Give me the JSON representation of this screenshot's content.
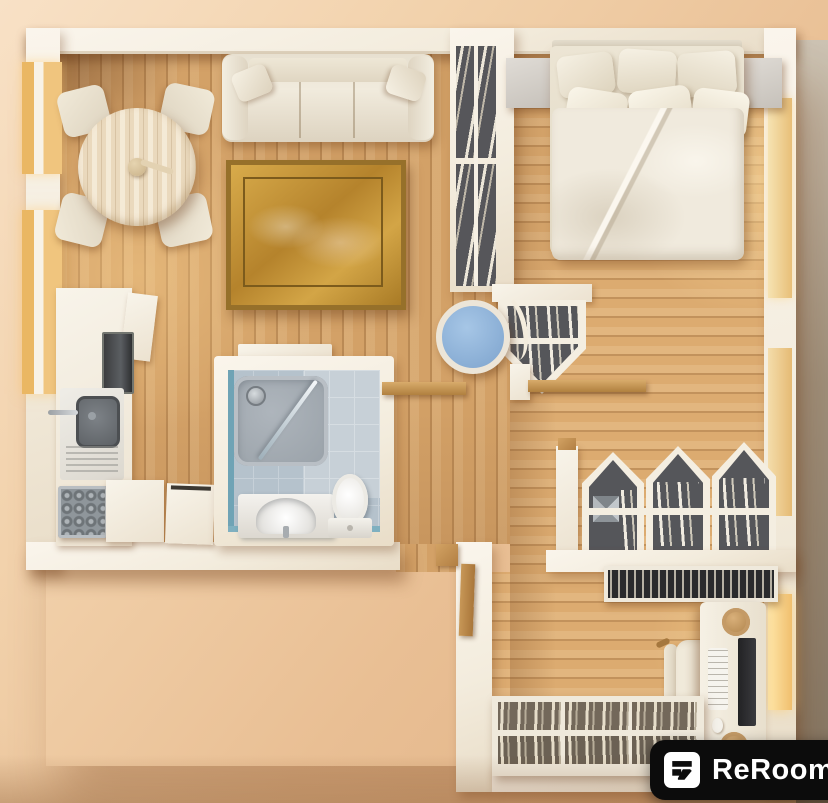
{
  "watermark": {
    "text": "ReRoom",
    "icon": "reroom-logo-icon",
    "bg": "#0c0c0c",
    "fg": "#ffffff"
  },
  "scene": {
    "type": "top-down 3D floor plan render",
    "rooms": [
      {
        "name": "living-dining-room",
        "items": [
          "cream sofa with throw pillows",
          "round birch dining table",
          "4 dining chairs",
          "gilded picture frame with sky canvas",
          "wall console shelf"
        ]
      },
      {
        "name": "kitchen",
        "items": [
          "counter run",
          "built-in oven",
          "sink with faucet",
          "drainboard",
          "cooktop hob",
          "dishwasher",
          "washing machine"
        ]
      },
      {
        "name": "bathroom",
        "items": [
          "corner shower with glass screen",
          "shower head",
          "vanity sink",
          "toilet",
          "blue-grey tile floor"
        ]
      },
      {
        "name": "bedroom",
        "items": [
          "double bed with 6 pillows and duvet",
          "left nightstand",
          "right nightstand",
          "tall divider bookshelf",
          "pentagon wall shelf",
          "blue stool",
          "wooden wall ledges"
        ]
      },
      {
        "name": "home-office",
        "items": [
          "desk",
          "monitor",
          "keyboard",
          "mouse",
          "2 woven planters",
          "office chair",
          "gabled shelf unit",
          "record shelf",
          "low bookshelf",
          "entry door"
        ]
      }
    ],
    "windows": [
      "left-upper",
      "left-lower",
      "right-upper",
      "right-middle",
      "office-right"
    ]
  },
  "palette": {
    "background": "#f0cfa9",
    "wall": "#f6f0e6",
    "wood_floor": "#d3a167",
    "bedroom_floor": "#dcab70",
    "bathroom_tile": "#b5c2cc",
    "shower_tray": "#a3abb2",
    "stool_blue": "#8fb4d9",
    "frame_gold": "#c49a43",
    "shelf_interior": "#55565a",
    "window_glow": "#f2c377",
    "logo_bg": "#0c0c0c",
    "logo_fg": "#ffffff"
  }
}
